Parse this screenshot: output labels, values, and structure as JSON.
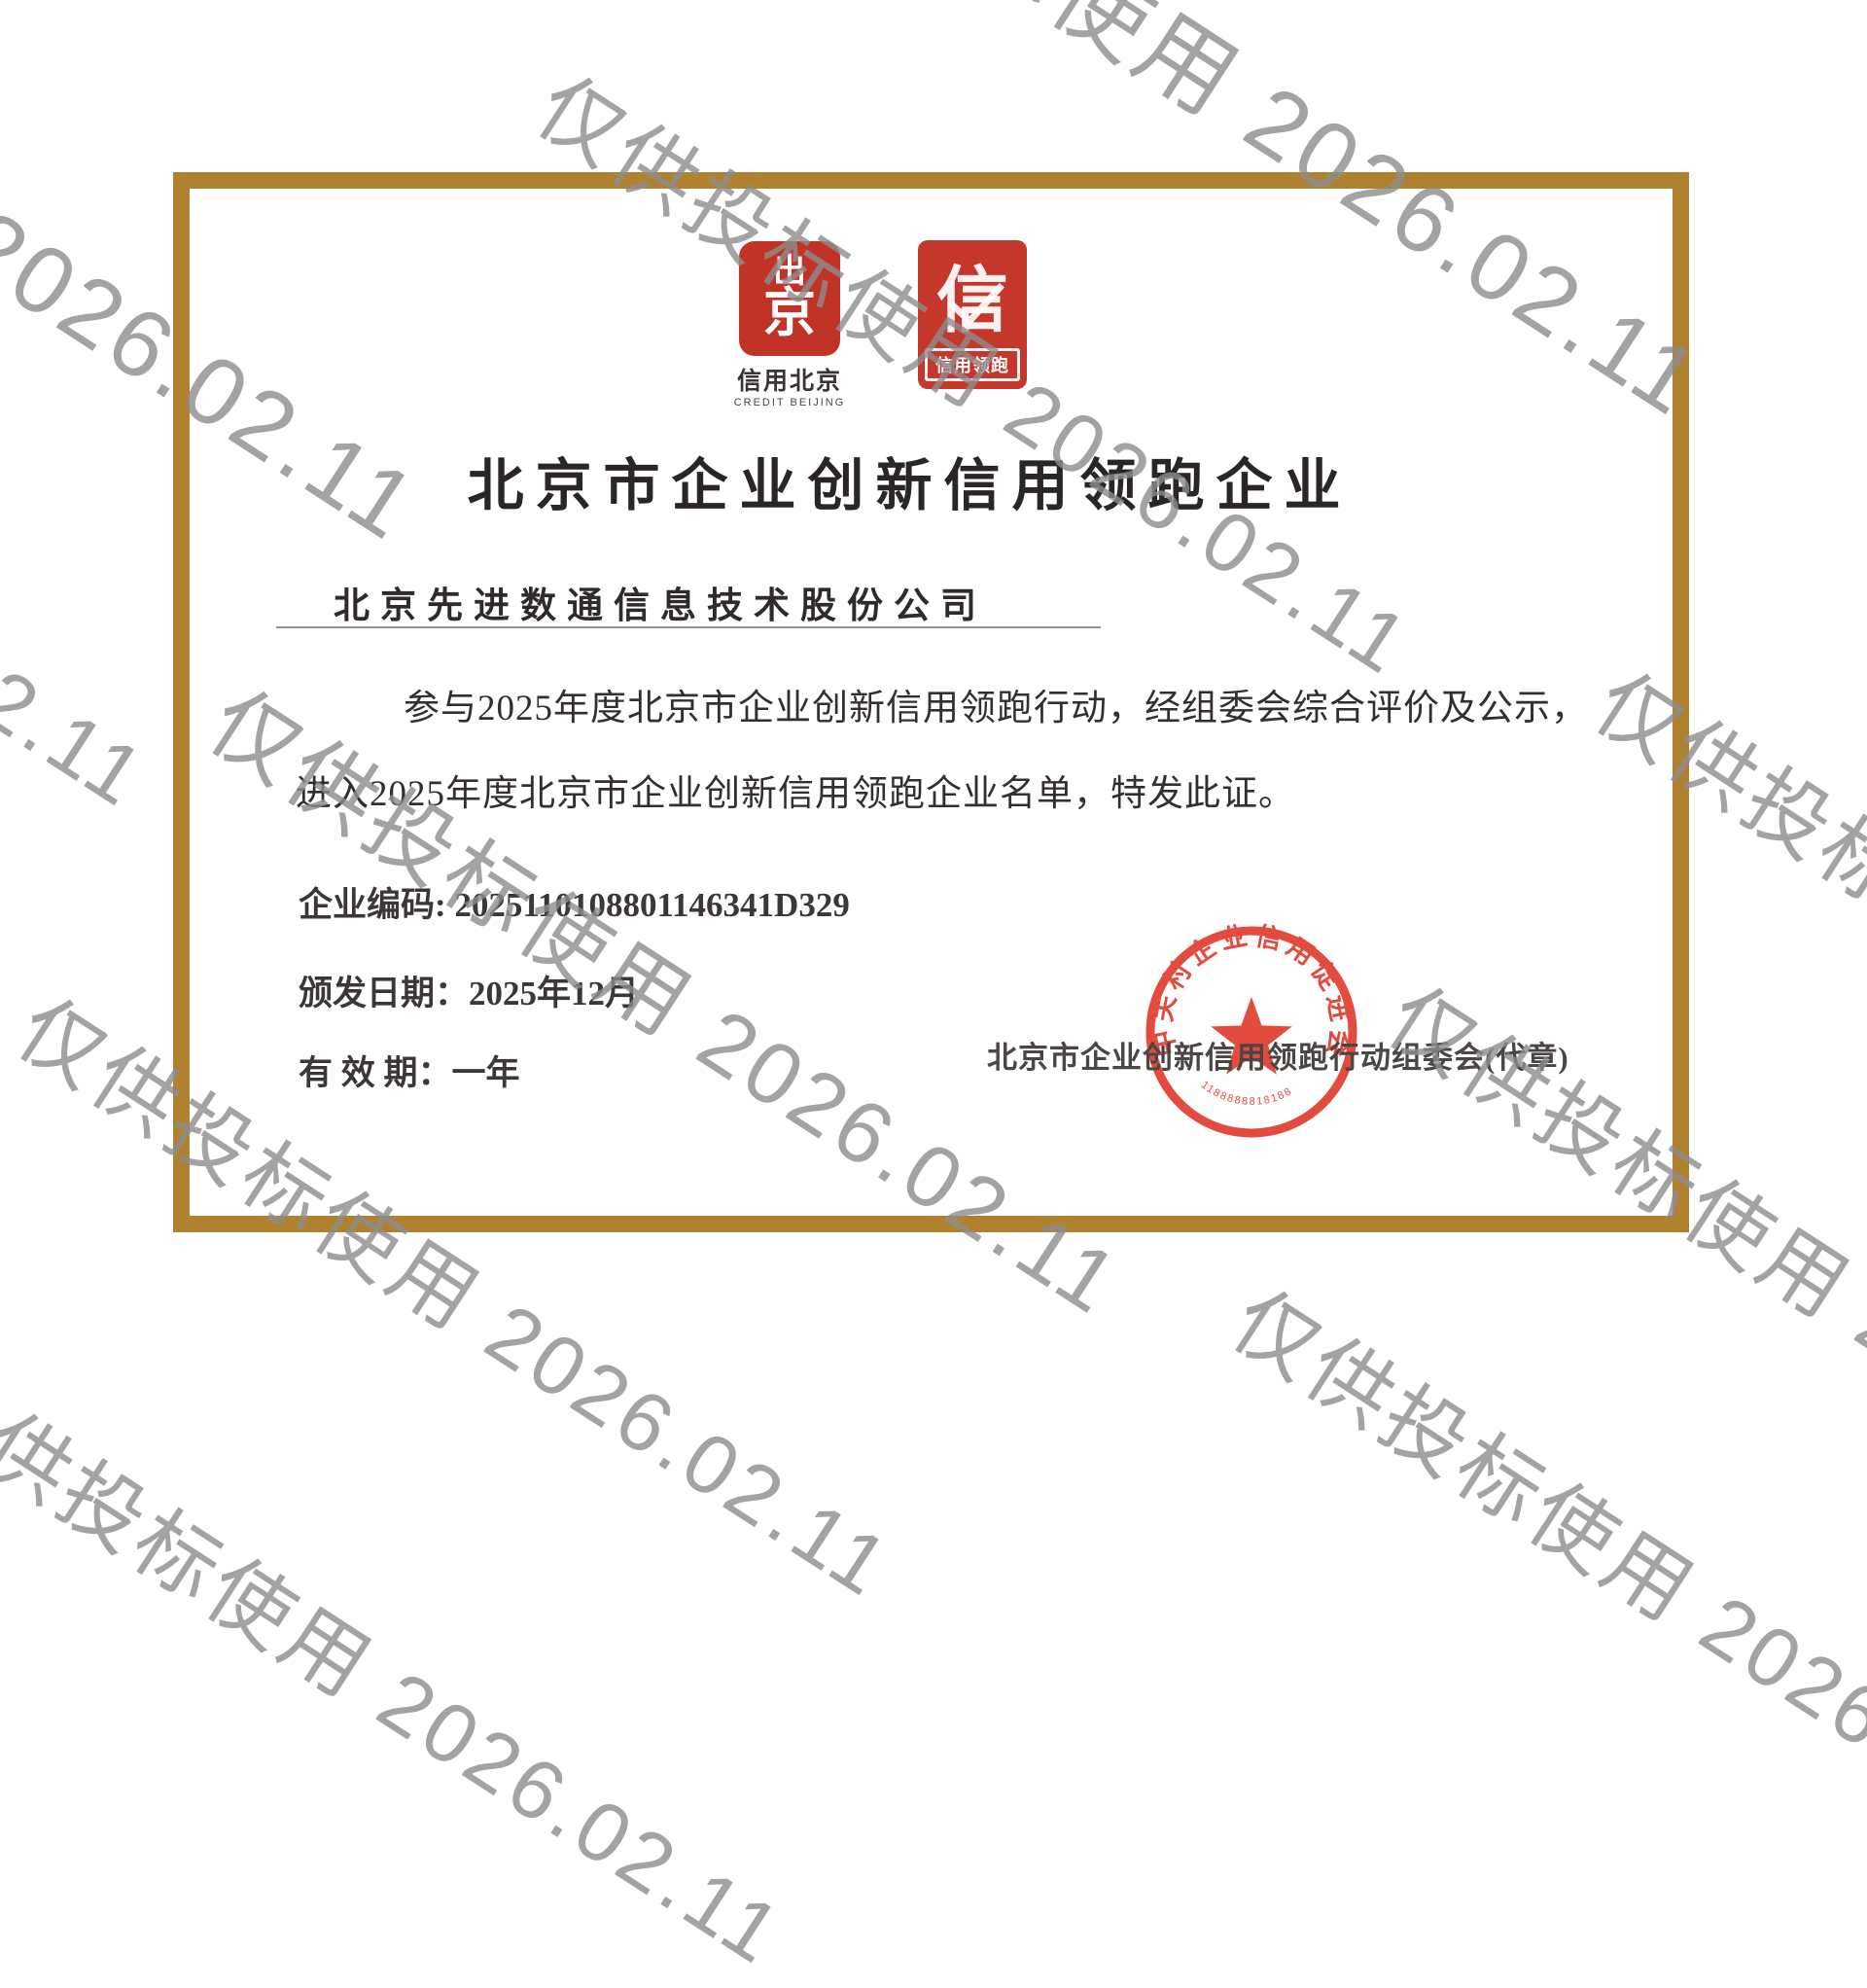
{
  "watermark": {
    "text": "仅供投标使用 2026.02.11",
    "color": "#8d8d8d"
  },
  "certificate": {
    "border_color": "#b0812f",
    "accent_red": "#c5372b",
    "stamp_red": "#e0382a",
    "logos": {
      "credit_beijing": {
        "glyph_top": "出",
        "glyph_bottom": "京",
        "label_cn": "信用北京",
        "label_en": "CREDIT BEIJING"
      },
      "credit_leading": {
        "glyph": "信",
        "label": "信用领跑"
      }
    },
    "title": "北京市企业创新信用领跑企业",
    "company_name": "北京先进数通信息技术股份公司",
    "body_line1": "参与2025年度北京市企业创新信用领跑行动，经组委会综合评价及公示，",
    "body_line2": "进入2025年度北京市企业创新信用领跑企业名单，特发此证。",
    "fields": {
      "code_label": "企业编码: ",
      "code_value": "2025110108801146341D329",
      "issue_label": "颁发日期：",
      "issue_value": "2025年12月",
      "validity_label": "有 效 期：",
      "validity_value": "一年"
    },
    "issuer": "北京市企业创新信用领跑行动组委会(代章)",
    "stamp": {
      "ring_text": "中关村企业信用促进会",
      "serial": "1188888818188"
    }
  }
}
